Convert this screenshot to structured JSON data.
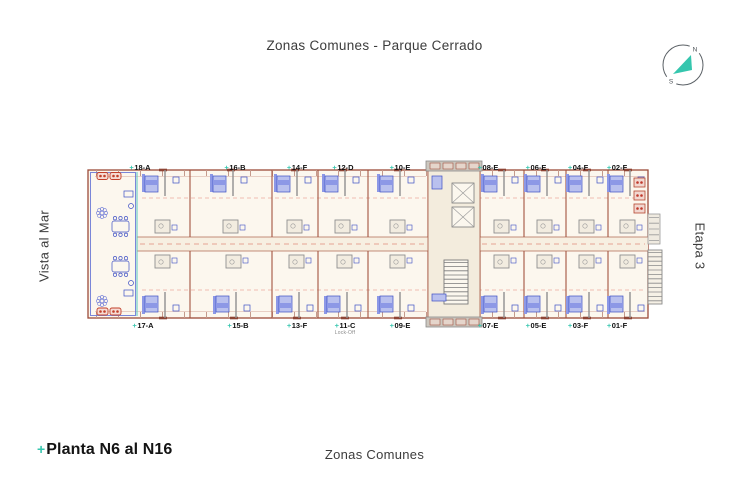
{
  "header": {
    "title": "Zonas Comunes - Parque Cerrado"
  },
  "footer": {
    "marker": "+",
    "title": "Planta N6 al N16",
    "subtitle": "Zonas Comunes"
  },
  "sides": {
    "left": "Vista al Mar",
    "right": "Etapa 3"
  },
  "compass": {
    "north": "N",
    "south": "S"
  },
  "colors": {
    "accent_teal": "#35c6ae",
    "wall_maroon": "#9c4b38",
    "dashed_red": "#e08a78",
    "furniture_blue": "#3d4fc4",
    "floor_beige": "#fcf7ee"
  },
  "plan": {
    "marker": "+",
    "top_units": [
      {
        "label": "18-A"
      },
      {
        "label": "16-B"
      },
      {
        "label": "14-F"
      },
      {
        "label": "12-D"
      },
      {
        "label": "10-E"
      },
      {
        "label": "08-E"
      },
      {
        "label": "06-E"
      },
      {
        "label": "04-F"
      },
      {
        "label": "02-F"
      }
    ],
    "bottom_units": [
      {
        "label": "17-A"
      },
      {
        "label": "15-B"
      },
      {
        "label": "13-F"
      },
      {
        "label": "11-C",
        "sublabel": "Lock-Off"
      },
      {
        "label": "09-E"
      },
      {
        "label": "07-E"
      },
      {
        "label": "05-E"
      },
      {
        "label": "03-F"
      },
      {
        "label": "01-F"
      }
    ]
  }
}
